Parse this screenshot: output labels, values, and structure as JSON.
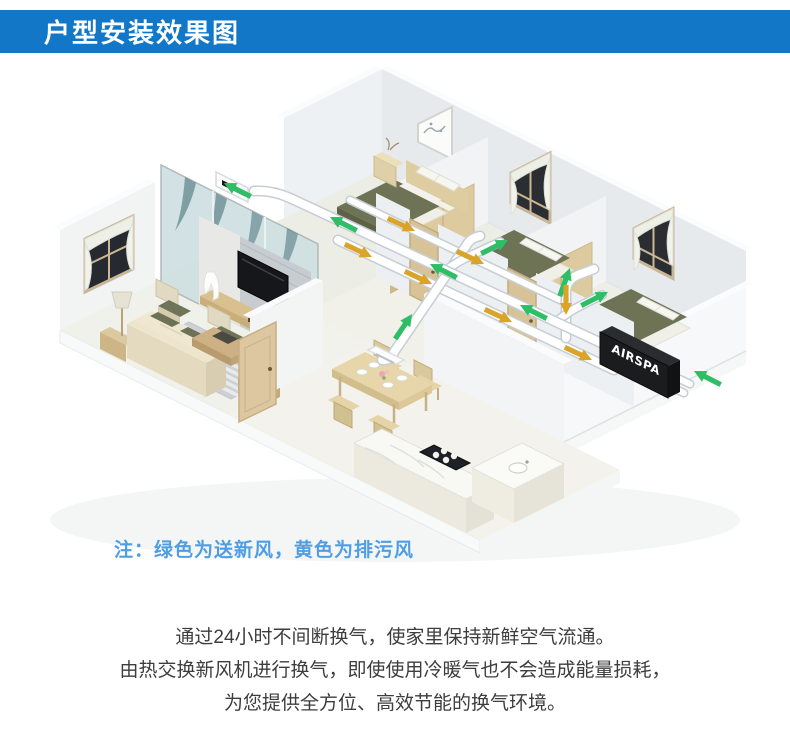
{
  "header": {
    "title": "户型安装效果图",
    "bg_color": "#1277c7",
    "text_color": "#ffffff"
  },
  "scene": {
    "unit_label": "AIRSPA",
    "colors": {
      "fresh_air_green": "#2fbd66",
      "exhaust_air_yellow": "#d9a427",
      "duct_white": "#ffffff",
      "wall_light": "#f2f4f5",
      "wood": "#dcc9a0",
      "bedding_olive": "#6e7356"
    }
  },
  "note": {
    "text": "注：绿色为送新风，黄色为排污风",
    "color": "#4f9ee5"
  },
  "description": {
    "lines": [
      "通过24小时不间断换气，使家里保持新鲜空气流通。",
      "由热交换新风机进行换气，即使使用冷暖气也不会造成能量损耗，",
      "为您提供全方位、高效节能的换气环境。"
    ]
  }
}
